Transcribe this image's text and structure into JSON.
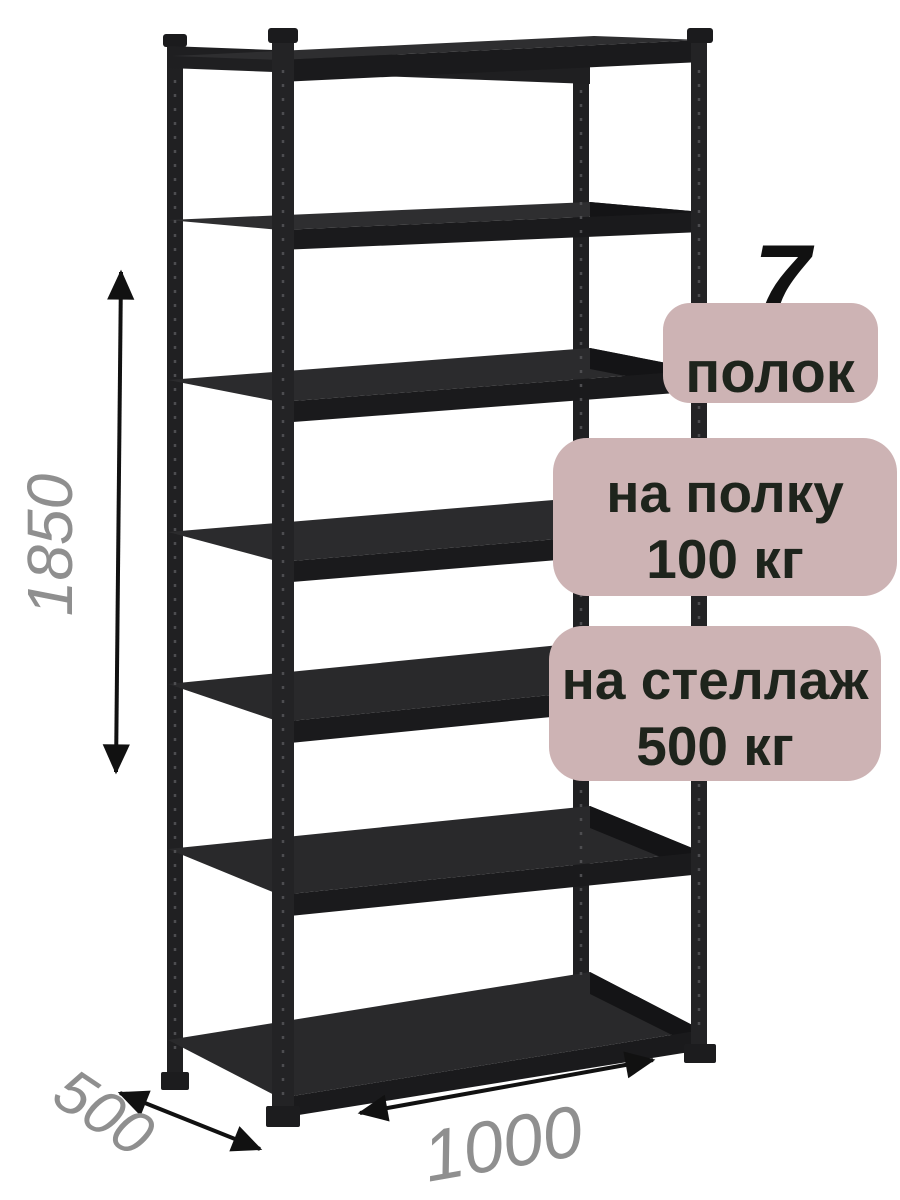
{
  "rack": {
    "description_label": "металлический стеллаж",
    "shelves_visible": 7,
    "posts_visible": 4
  },
  "badges": {
    "shelf_count": {
      "number": "7",
      "label": "полок"
    },
    "per_shelf": {
      "line1": "на полку",
      "line2": "100 кг"
    },
    "per_rack": {
      "line1": "на стеллаж",
      "line2": "500 кг"
    }
  },
  "dimensions": {
    "height": "1850",
    "width": "1000",
    "depth": "500"
  },
  "colors": {
    "background": "#ffffff",
    "badge_bg": "#cdb3b4",
    "badge_text": "#1e241c",
    "count_text": "#111111",
    "dimension_text": "#8f8f8f",
    "arrow": "#111111",
    "rack_metal_dark": "#1a1a1c",
    "rack_metal": "#232325",
    "rack_metal_light": "#2e2e30"
  }
}
